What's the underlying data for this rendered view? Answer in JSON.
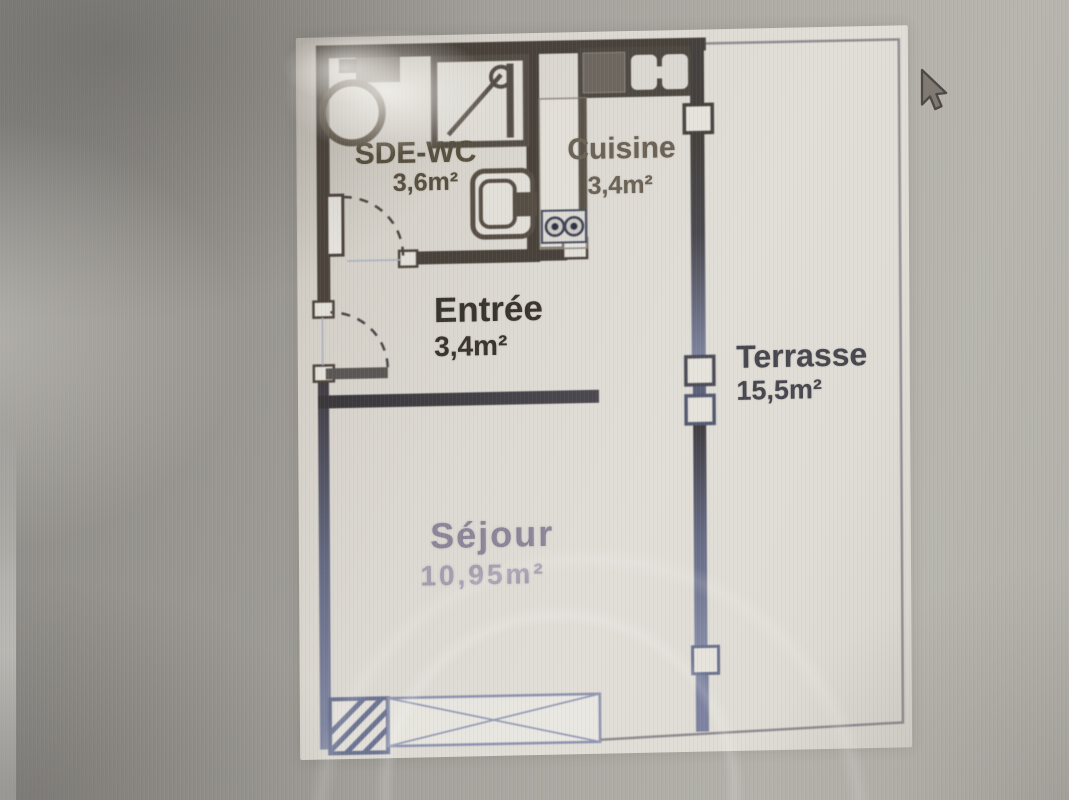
{
  "page": {
    "type": "photo-of-screen",
    "subject": "apartment floor plan"
  },
  "rooms": [
    {
      "name": "SDE-WC",
      "area": "3,6m²"
    },
    {
      "name": "Cuisine",
      "area": "3,4m²"
    },
    {
      "name": "Entrée",
      "area": "3,4m²"
    },
    {
      "name": "Terrasse",
      "area": "15,5m²"
    },
    {
      "name": "Séjour",
      "area": "10,95m²"
    }
  ],
  "fixtures": [
    "washbasin-icon",
    "shower-icon",
    "toilet-icon",
    "kitchen-counter",
    "kitchen-sink-icon",
    "cooktop-icon",
    "window-markers",
    "door-swing-arcs",
    "bay-window",
    "hatched-column"
  ],
  "cursor": {
    "visible": true
  },
  "colors": {
    "wall_dark": "#49423b",
    "wall_faded": "#7e84a0",
    "label_entree": "#38342f",
    "label_warm": "#57503f",
    "label_terrasse": "#47474f",
    "label_sejour": "#8d8598",
    "paper": "#dedbd4",
    "backdrop": "#a8a5a0"
  }
}
